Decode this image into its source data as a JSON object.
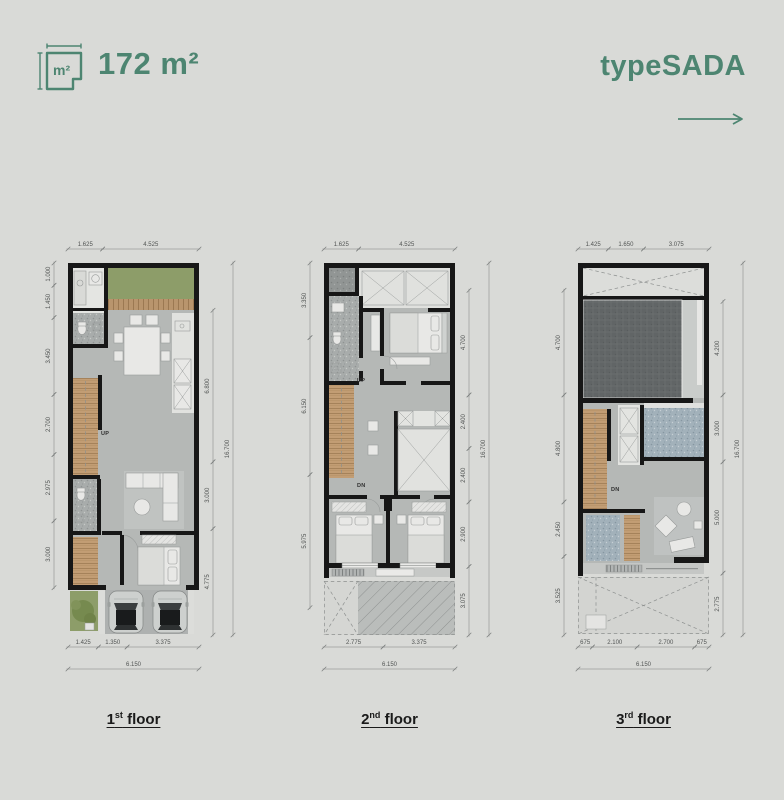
{
  "accent": "#4d8571",
  "header": {
    "icon_label": "m²",
    "area_value": "172 m²",
    "type_name": "typeSADA"
  },
  "plan_meta": {
    "width_m": 6.15,
    "height_m": 16.7
  },
  "floors": [
    {
      "label_num": "1",
      "label_sup": "st",
      "label_rest": " floor",
      "stair_up": "UP",
      "dims": {
        "top": [
          {
            "label": "1.625",
            "m": 1.625
          },
          {
            "label": "4.525",
            "m": 4.525
          }
        ],
        "top_offset": 0,
        "bottom": [
          {
            "label": "1.425",
            "m": 1.425
          },
          {
            "label": "1.350",
            "m": 1.35
          },
          {
            "label": "3.375",
            "m": 3.375
          }
        ],
        "bottom_offset": 0,
        "bottom_overall": "6.150",
        "left": [
          {
            "label": "1.000",
            "m": 1.0
          },
          {
            "label": "1.450",
            "m": 1.45
          },
          {
            "label": "3.450",
            "m": 3.45
          },
          {
            "label": "2.700",
            "m": 2.7
          },
          {
            "label": "2.975",
            "m": 2.975
          },
          {
            "label": "3.000",
            "m": 3.0
          }
        ],
        "left_offset": 0,
        "right": [
          {
            "label": "6.800",
            "m": 6.8
          },
          {
            "label": "3.000",
            "m": 3.0
          },
          {
            "label": "4.775",
            "m": 4.775
          }
        ],
        "right_offset": 2.125,
        "right_overall": "16.700"
      }
    },
    {
      "label_num": "2",
      "label_sup": "nd",
      "label_rest": " floor",
      "stair_up": "UP",
      "stair_dn": "DN",
      "dims": {
        "top": [
          {
            "label": "1.625",
            "m": 1.625
          },
          {
            "label": "4.525",
            "m": 4.525
          }
        ],
        "top_offset": 0,
        "bottom": [
          {
            "label": "2.775",
            "m": 2.775
          },
          {
            "label": "3.375",
            "m": 3.375
          }
        ],
        "bottom_offset": 0,
        "bottom_overall": "6.150",
        "left": [
          {
            "label": "3.350",
            "m": 3.35
          },
          {
            "label": "6.150",
            "m": 6.15
          },
          {
            "label": "5.975",
            "m": 5.975
          }
        ],
        "left_offset": 0,
        "right": [
          {
            "label": "4.700",
            "m": 4.7
          },
          {
            "label": "2.400",
            "m": 2.4
          },
          {
            "label": "2.400",
            "m": 2.4
          },
          {
            "label": "2.900",
            "m": 2.9
          },
          {
            "label": "3.075",
            "m": 3.075
          }
        ],
        "right_offset": 1.225,
        "right_overall": "16.700"
      }
    },
    {
      "label_num": "3",
      "label_sup": "rd",
      "label_rest": " floor",
      "stair_dn": "DN",
      "dims": {
        "top": [
          {
            "label": "1.425",
            "m": 1.425
          },
          {
            "label": "1.650",
            "m": 1.65
          },
          {
            "label": "3.075",
            "m": 3.075
          }
        ],
        "top_offset": 0,
        "bottom": [
          {
            "label": "675",
            "m": 0.675
          },
          {
            "label": "2.100",
            "m": 2.1
          },
          {
            "label": "2.700",
            "m": 2.7
          },
          {
            "label": "675",
            "m": 0.675
          }
        ],
        "bottom_offset": 0,
        "bottom_overall": "6.150",
        "left": [
          {
            "label": "4.700",
            "m": 4.7
          },
          {
            "label": "4.800",
            "m": 4.8
          },
          {
            "label": "2.450",
            "m": 2.45
          },
          {
            "label": "3.525",
            "m": 3.525
          }
        ],
        "left_offset": 1.225,
        "right": [
          {
            "label": "4.200",
            "m": 4.2
          },
          {
            "label": "3.000",
            "m": 3.0
          },
          {
            "label": "5.000",
            "m": 5.0
          },
          {
            "label": "2.775",
            "m": 2.775
          }
        ],
        "right_offset": 1.725,
        "right_overall": "16.700"
      }
    }
  ]
}
